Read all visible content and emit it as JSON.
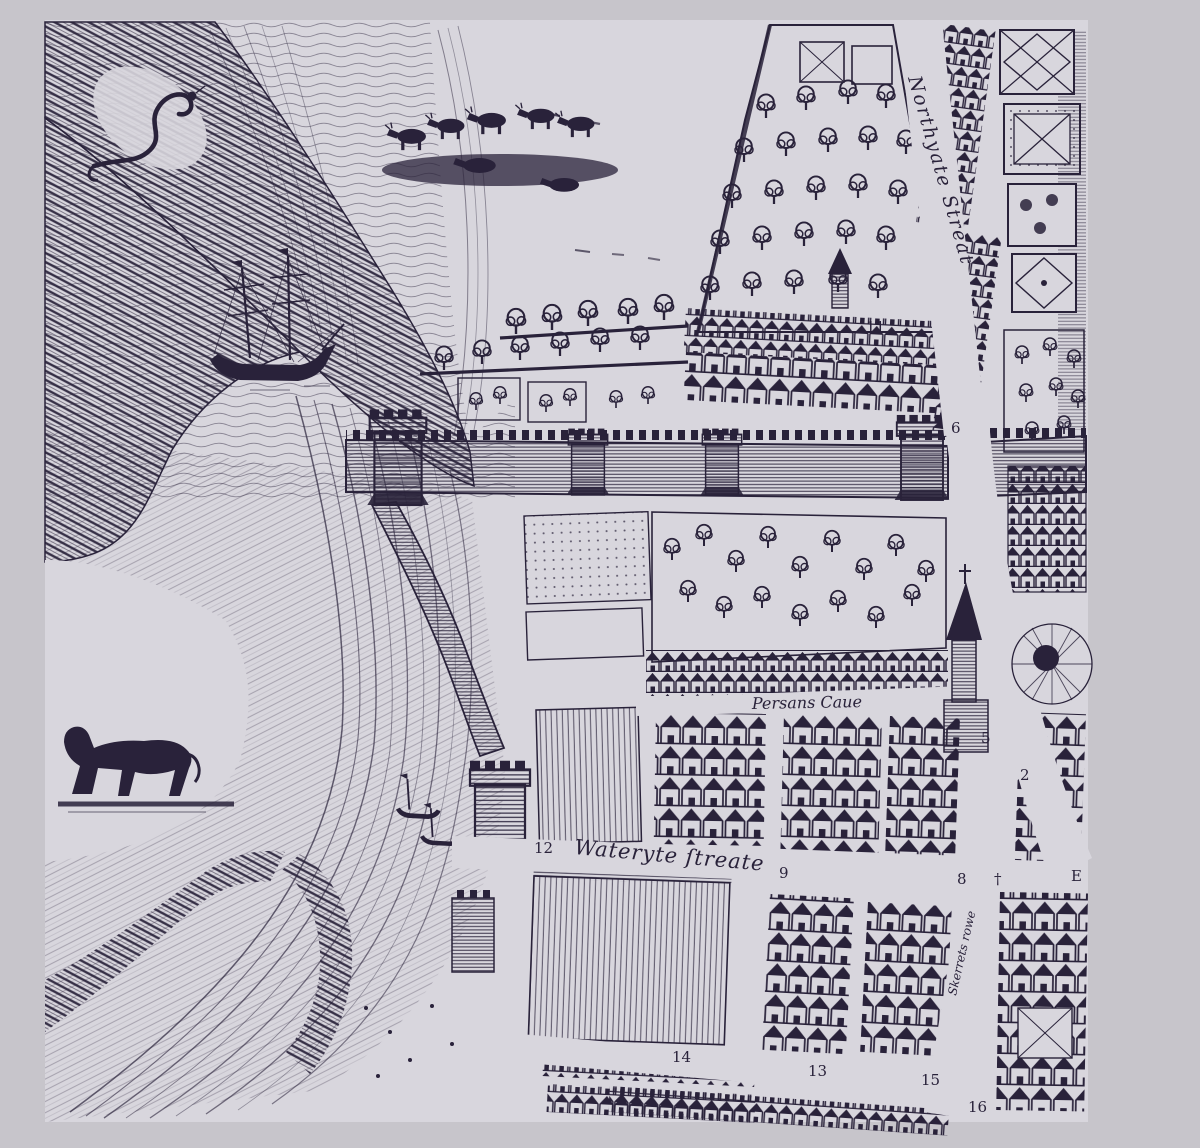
{
  "map": {
    "description": "Engraved early-modern town plan detail with river, walls and streets",
    "labels": {
      "northgate": "Northyate Streat",
      "persans": "Persans Caue",
      "watergate": "Wateryte ſtreate",
      "skerrets": "Skerrets rowe"
    },
    "markers": [
      {
        "label": "11"
      },
      {
        "label": "6"
      },
      {
        "label": "12"
      },
      {
        "label": "9"
      },
      {
        "label": "8"
      },
      {
        "label": "†"
      },
      {
        "label": "E"
      },
      {
        "label": "5"
      },
      {
        "label": "2"
      },
      {
        "label": "14"
      },
      {
        "label": "13"
      },
      {
        "label": "15"
      },
      {
        "label": "16"
      }
    ],
    "colors": {
      "ink": "#29223a",
      "paper": "#d8d6dd",
      "frame": "#c7c5cb"
    }
  }
}
